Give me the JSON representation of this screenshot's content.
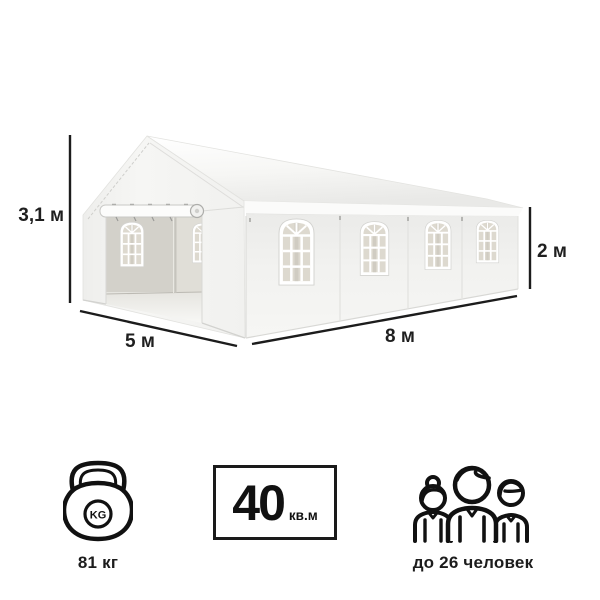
{
  "illustration": {
    "description": "white-party-tent-5x8",
    "dimension_labels": {
      "height": "3,1 м",
      "front_width": "5 м",
      "side_length": "8 м",
      "wall_height": "2 м"
    }
  },
  "specs": {
    "weight": {
      "icon": "kettlebell-icon",
      "icon_text": "KG",
      "label": "81 кг"
    },
    "area": {
      "icon": "area-badge",
      "value": "40",
      "unit": "кв.м"
    },
    "capacity": {
      "icon": "people-icon",
      "label": "до 26 человек"
    }
  },
  "colors": {
    "dimension_line": "#1c1c1c",
    "text": "#1f1f1f",
    "icon_stroke": "#111111",
    "tent_wall": "#f3f3f1",
    "tent_interior": "#d3d1ca",
    "window_glass": "#ddd9cf"
  }
}
